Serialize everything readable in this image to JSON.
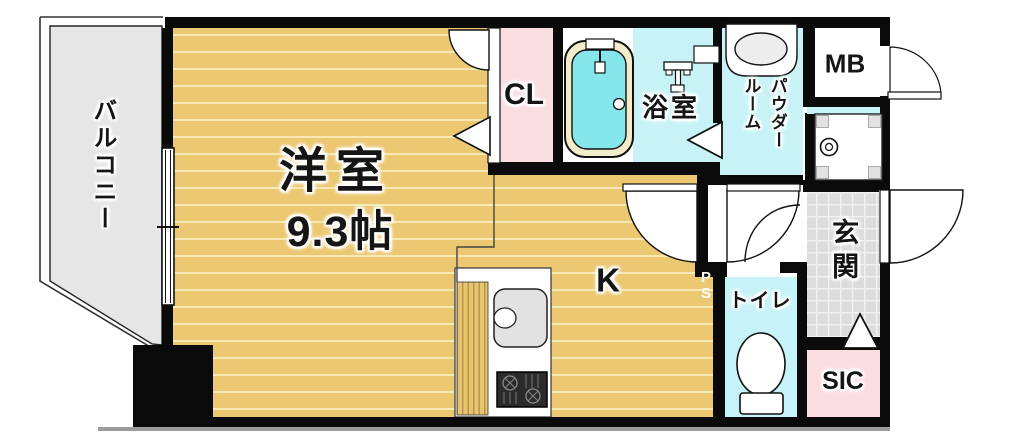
{
  "floorplan": {
    "title": "1K apartment floor plan",
    "rooms": {
      "balcony": {
        "label": "バルコニー"
      },
      "living": {
        "label": "洋室",
        "size": "9.3帖"
      },
      "closet": {
        "label": "CL"
      },
      "bath": {
        "label": "浴室"
      },
      "powder": {
        "label": "パウダー\nルーム"
      },
      "meter_box": {
        "label": "MB"
      },
      "entrance": {
        "label": "玄関"
      },
      "toilet": {
        "label": "トイレ"
      },
      "shoe_closet": {
        "label": "SIC"
      },
      "kitchen": {
        "label": "K"
      },
      "pipe_space": {
        "label": "P\nS"
      }
    },
    "colors": {
      "wall": "#0a0a0a",
      "wood": "#ecc873",
      "wood_line": "#f7e9b4",
      "water_cyan": "#c8f3f6",
      "bathtub_cyan": "#85e7ec",
      "closet_pink": "#fadde1",
      "entrance_tile": "#dcdcdc",
      "balcony_gray": "#e6e6e6"
    }
  }
}
